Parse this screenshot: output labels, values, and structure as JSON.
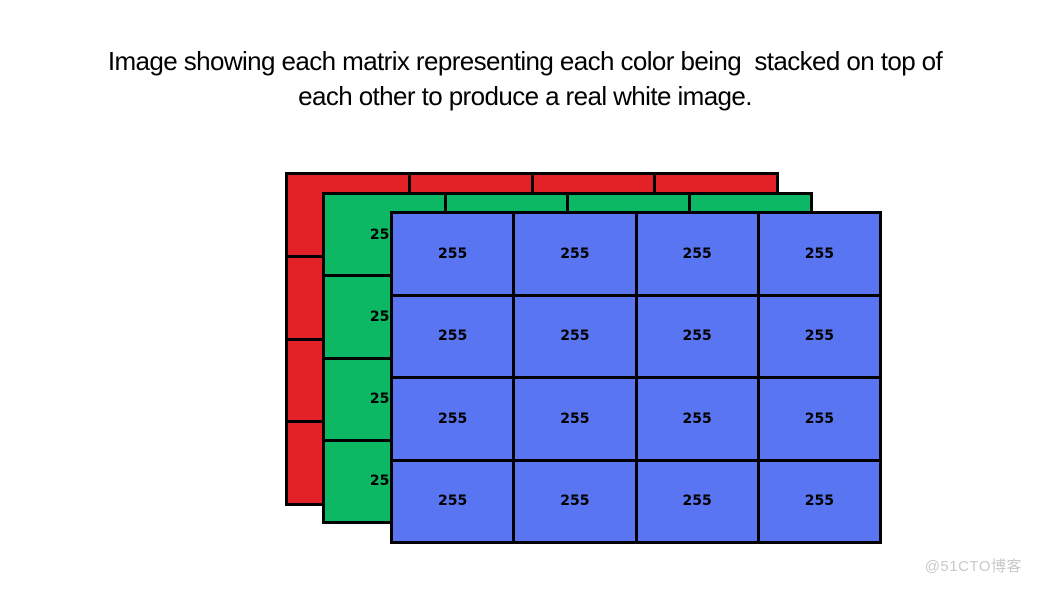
{
  "title": {
    "line1": "Image showing each matrix representing each color being  stacked on top of",
    "line2": "each other to produce a real white image."
  },
  "watermark": "@51CTO博客",
  "colors": {
    "red_channel": "#e32227",
    "green_channel": "#0cb863",
    "blue_channel": "#5a75f1",
    "grid_border": "#000000",
    "cell_text": "#000000",
    "title_text": "#000000",
    "watermark_text": "#c9c9c9",
    "background": "#ffffff"
  },
  "matrices": [
    {
      "name": "red-channel-matrix",
      "color": "#e32227",
      "rows": 4,
      "cols": 4,
      "cells": [
        "255",
        "255",
        "255",
        "255",
        "255",
        "255",
        "255",
        "255",
        "255",
        "255",
        "255",
        "255",
        "255",
        "255",
        "255",
        "255"
      ]
    },
    {
      "name": "green-channel-matrix",
      "color": "#0cb863",
      "rows": 4,
      "cols": 4,
      "cells": [
        "255",
        "255",
        "255",
        "255",
        "255",
        "255",
        "255",
        "255",
        "255",
        "255",
        "255",
        "255",
        "255",
        "255",
        "255",
        "255"
      ]
    },
    {
      "name": "blue-channel-matrix",
      "color": "#5a75f1",
      "rows": 4,
      "cols": 4,
      "cells": [
        "255",
        "255",
        "255",
        "255",
        "255",
        "255",
        "255",
        "255",
        "255",
        "255",
        "255",
        "255",
        "255",
        "255",
        "255",
        "255"
      ]
    }
  ]
}
